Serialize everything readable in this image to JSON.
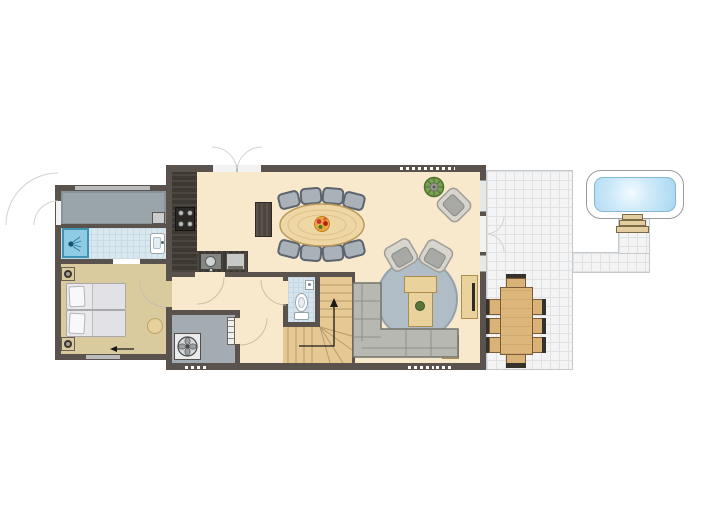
{
  "title": "Holiday home ground-floor plan with terrace and hot tub",
  "floor": "ground-floor",
  "rooms": [
    {
      "name": "veranda-storage",
      "floor_color": "#9aa5ab"
    },
    {
      "name": "bathroom",
      "floor_color": "#d9e7ef",
      "fixtures": [
        "shower",
        "washbasin"
      ]
    },
    {
      "name": "bedroom",
      "floor_color": "#d9cb9e",
      "furniture": [
        "double-bed",
        "nightstand-left",
        "nightstand-right",
        "stool"
      ]
    },
    {
      "name": "living-room",
      "floor_color": "#f8e9cd",
      "furniture": [
        "oval-dining-table",
        "eight-dining-chairs",
        "sideboard",
        "corner-sofa",
        "round-rug",
        "coffee-table",
        "two-armchairs",
        "accent-armchair",
        "tv-cabinet",
        "side-table",
        "potted-plant"
      ]
    },
    {
      "name": "open-kitchen",
      "floor_color": "#f8e9cd",
      "fixtures": [
        "l-shaped-counter",
        "hob-4-burners",
        "sink",
        "dishwasher"
      ]
    },
    {
      "name": "hallway",
      "floor_color": "#f8e9cd"
    },
    {
      "name": "toilet-room",
      "floor_color": "#d6e4ee",
      "fixtures": [
        "wc",
        "small-basin"
      ]
    },
    {
      "name": "utility-room",
      "floor_color": "#a2acb2",
      "fixtures": [
        "washing-machine-fan-unit",
        "shelving"
      ]
    },
    {
      "name": "staircase",
      "floor_color": "#e6c893",
      "detail": "winder-stairs-with-up-arrow"
    },
    {
      "name": "terrace",
      "floor_color": "#f4f4f4",
      "furniture": [
        "outdoor-dining-table",
        "eight-outdoor-chairs"
      ]
    },
    {
      "name": "hot-tub-deck",
      "fixtures": [
        "hot-tub",
        "steps"
      ]
    }
  ],
  "doors": [
    "double-garden-door-top",
    "terrace-double-door-right",
    "entrance-door-left",
    "living-to-hallway-door",
    "hallway-to-bedroom-door",
    "bedroom-to-bathroom-door",
    "toilet-door",
    "utility-door"
  ],
  "windows": [
    "top-wall-dotted-window",
    "bottom-wall-dotted-windows",
    "right-wall-windows",
    "bedroom-window",
    "veranda-window"
  ],
  "colors": {
    "wall": "#5a534d",
    "living_floor": "#f8e9cd",
    "bedroom_floor": "#d9cb9e",
    "bath_tile": "#d9e7ef",
    "shower_blue": "#8fcbe2",
    "veranda_gray": "#9aa5ab",
    "utility_gray": "#a2acb2",
    "stairs_wood": "#e6c893",
    "furniture_wood": "#ead29d",
    "dining_table_wood": "#eed7a4",
    "kitchen_counter": "#3e3833",
    "chair_gray": "#a9b1b9",
    "sofa_gray": "#b4b4af",
    "rug_gray": "#b0bdc7",
    "terrace_tile": "#f4f4f4",
    "pool_water": "#a8d8f0",
    "fruit_bowl": "#eaa93f"
  }
}
